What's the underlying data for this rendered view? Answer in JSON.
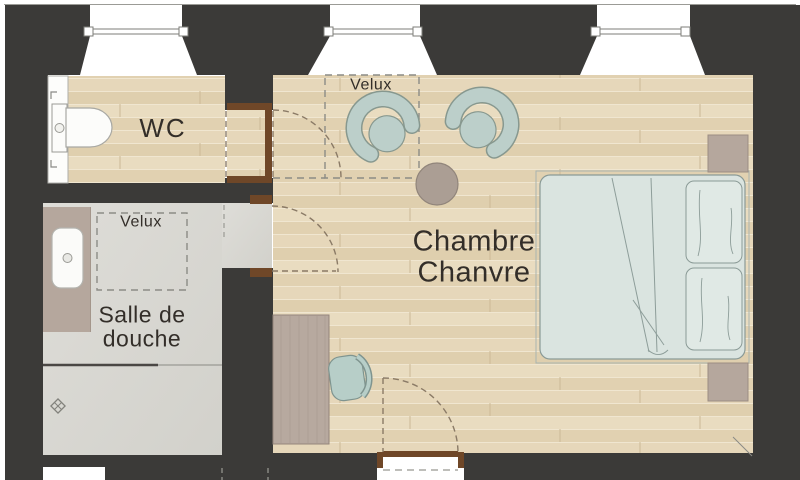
{
  "floorplan": {
    "rooms": [
      {
        "name": "wc",
        "label": "WC"
      },
      {
        "name": "shower-room",
        "label_lines": [
          "Salle de",
          "douche"
        ]
      },
      {
        "name": "bedroom",
        "label_lines": [
          "Chambre",
          "Chanvre"
        ]
      }
    ],
    "skylights": [
      {
        "room": "bedroom",
        "label": "Velux"
      },
      {
        "room": "shower-room",
        "label": "Velux"
      }
    ],
    "furniture": [
      "armchair",
      "armchair",
      "round-side-table",
      "double-bed",
      "pillow",
      "pillow",
      "nightstand",
      "nightstand",
      "desk",
      "desk-chair",
      "toilet",
      "washbasin-vanity",
      "shower-screen",
      "floor-drain"
    ],
    "windows_count": 3,
    "doors_count": 3,
    "colors": {
      "wall": "#3b3a38",
      "wood_floor": "#e6d7b9",
      "concrete_floor": "#dcdbd5",
      "door_frame_wood": "#6f4728",
      "upholstery_teal": "#bccfca",
      "bedding": "#dae4e0",
      "furniture_taupe": "#b5a79d",
      "text_color": "#332e29"
    }
  }
}
